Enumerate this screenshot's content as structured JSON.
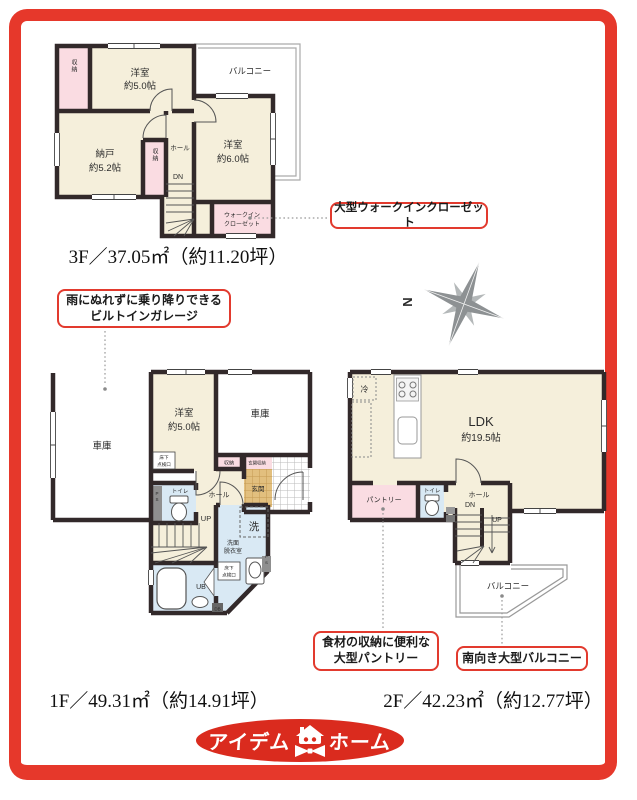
{
  "colors": {
    "frame_red": "#e6382b",
    "callout_red": "#e23a2e",
    "logo_red": "#da2b1e",
    "wall": "#32292a",
    "room_cream": "#f5efdb",
    "closet_pink": "#fadce2",
    "wet_blue": "#d9e9f4",
    "entry_tan": "#e2bf7e"
  },
  "compass": {
    "north": "N"
  },
  "floor3": {
    "area": "3F／37.05㎡（約11.20坪）",
    "balcony": "バルコニー",
    "room1_name": "洋室",
    "room1_size": "約5.0帖",
    "room2_name": "納戸",
    "room2_size": "約5.2帖",
    "room3_name": "洋室",
    "room3_size": "約6.0帖",
    "closet1": "収納",
    "closet2": "収納",
    "hall": "ホール",
    "dn": "DN",
    "wic_line1": "ウォークイン",
    "wic_line2": "クローゼット"
  },
  "floor1": {
    "area": "1F／49.31㎡（約14.91坪）",
    "garage_left": "車庫",
    "garage_right": "車庫",
    "room_name": "洋室",
    "room_size": "約5.0帖",
    "hatch_line1": "床下",
    "hatch_line2": "点検口",
    "closet": "収納",
    "entrance_storage": "玄関収納",
    "entrance": "玄関",
    "toilet": "トイレ",
    "ps": "PS",
    "hall": "ホール",
    "up": "UP",
    "wash": "洗",
    "washroom_line1": "洗面",
    "washroom_line2": "脱衣室",
    "bath": "UB",
    "db": "DB"
  },
  "floor2": {
    "area": "2F／42.23㎡（約12.77坪）",
    "fridge": "冷",
    "ldk_name": "LDK",
    "ldk_size": "約19.5帖",
    "pantry": "パントリー",
    "toilet": "トイレ",
    "hall": "ホール",
    "dn": "DN",
    "up": "UP",
    "balcony": "バルコニー"
  },
  "callouts": {
    "wic": "大型ウォークインクローゼット",
    "garage_line1": "雨にぬれずに乗り降りできる",
    "garage_line2": "ビルトインガレージ",
    "pantry_line1": "食材の収納に便利な",
    "pantry_line2": "大型パントリー",
    "balcony": "南向き大型バルコニー"
  },
  "logo": {
    "left": "アイデム",
    "right": "ホーム"
  }
}
